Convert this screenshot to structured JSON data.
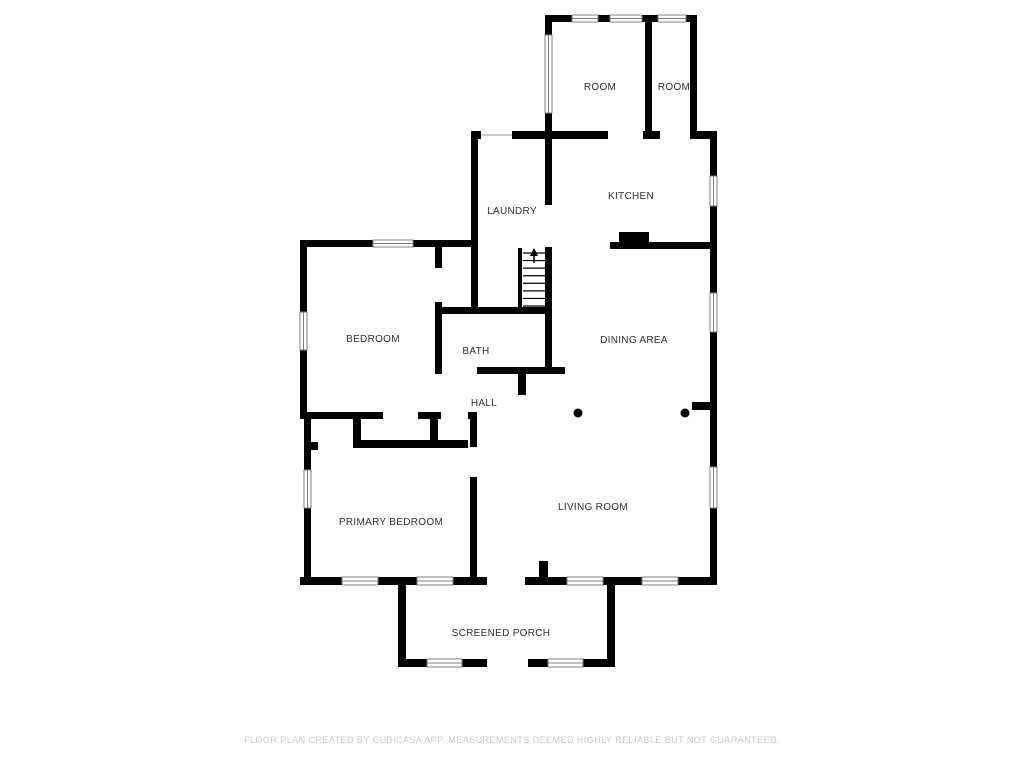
{
  "footer": {
    "text": "FLOOR PLAN CREATED BY CUBICASA APP. MEASUREMENTS DEEMED HIGHLY RELIABLE BUT NOT GUARANTEED.",
    "color": "#c9c9c9"
  },
  "plan": {
    "background": "#ffffff",
    "wall_color": "#000000",
    "label_color": "#303030",
    "window_stroke": "#7f7f7f",
    "door_line_color": "#bbbbbb",
    "rooms": [
      {
        "label": "ROOM",
        "x": 600,
        "y": 90
      },
      {
        "label": "ROOM",
        "x": 674,
        "y": 90
      },
      {
        "label": "LAUNDRY",
        "x": 512,
        "y": 214
      },
      {
        "label": "KITCHEN",
        "x": 631,
        "y": 199
      },
      {
        "label": "BEDROOM",
        "x": 373,
        "y": 342
      },
      {
        "label": "BATH",
        "x": 476,
        "y": 354
      },
      {
        "label": "DINING AREA",
        "x": 634,
        "y": 343
      },
      {
        "label": "HALL",
        "x": 484,
        "y": 406
      },
      {
        "label": "PRIMARY BEDROOM",
        "x": 391,
        "y": 525
      },
      {
        "label": "LIVING ROOM",
        "x": 593,
        "y": 510
      },
      {
        "label": "SCREENED PORCH",
        "x": 501,
        "y": 636
      }
    ],
    "walls": [
      [
        545,
        15,
        7,
        20
      ],
      [
        545,
        113,
        7,
        20
      ],
      [
        545,
        15,
        27,
        7
      ],
      [
        598,
        15,
        12,
        7
      ],
      [
        642,
        15,
        16,
        7
      ],
      [
        686,
        15,
        11,
        7
      ],
      [
        645,
        22,
        7,
        111
      ],
      [
        690,
        22,
        7,
        109
      ],
      [
        471,
        131,
        10,
        8
      ],
      [
        512,
        131,
        40,
        8
      ],
      [
        552,
        131,
        56,
        8
      ],
      [
        643,
        131,
        17,
        8
      ],
      [
        690,
        131,
        27,
        8
      ],
      [
        710,
        131,
        7,
        45
      ],
      [
        710,
        206,
        7,
        87
      ],
      [
        710,
        332,
        7,
        135
      ],
      [
        710,
        508,
        7,
        76
      ],
      [
        610,
        242,
        107,
        7
      ],
      [
        471,
        131,
        7,
        183
      ],
      [
        545,
        139,
        7,
        66
      ],
      [
        545,
        247,
        7,
        67
      ],
      [
        300,
        240,
        73,
        7
      ],
      [
        413,
        240,
        64,
        7
      ],
      [
        300,
        247,
        7,
        65
      ],
      [
        300,
        350,
        7,
        64
      ],
      [
        435,
        247,
        7,
        21
      ],
      [
        435,
        302,
        7,
        72
      ],
      [
        435,
        307,
        117,
        7
      ],
      [
        545,
        314,
        7,
        60
      ],
      [
        477,
        367,
        88,
        7
      ],
      [
        518,
        374,
        8,
        21
      ],
      [
        518,
        248,
        4,
        62
      ],
      [
        300,
        412,
        83,
        7
      ],
      [
        418,
        412,
        23,
        7
      ],
      [
        468,
        412,
        9,
        7
      ],
      [
        353,
        412,
        8,
        36
      ],
      [
        430,
        412,
        8,
        36
      ],
      [
        353,
        440,
        115,
        8
      ],
      [
        304,
        442,
        14,
        8
      ],
      [
        470,
        419,
        7,
        28
      ],
      [
        470,
        477,
        7,
        101
      ],
      [
        304,
        412,
        7,
        58
      ],
      [
        304,
        508,
        7,
        70
      ],
      [
        300,
        577,
        42,
        8
      ],
      [
        378,
        577,
        39,
        8
      ],
      [
        453,
        577,
        34,
        8
      ],
      [
        525,
        577,
        42,
        8
      ],
      [
        603,
        577,
        39,
        8
      ],
      [
        678,
        577,
        39,
        8
      ],
      [
        539,
        561,
        9,
        16
      ],
      [
        692,
        402,
        18,
        8
      ],
      [
        398,
        585,
        8,
        82
      ],
      [
        607,
        585,
        8,
        82
      ],
      [
        398,
        659,
        29,
        8
      ],
      [
        462,
        659,
        25,
        8
      ],
      [
        528,
        659,
        20,
        8
      ],
      [
        583,
        659,
        32,
        8
      ]
    ],
    "windows": [
      [
        545,
        35,
        7,
        78
      ],
      [
        572,
        15,
        26,
        7
      ],
      [
        610,
        15,
        32,
        7
      ],
      [
        658,
        15,
        28,
        7
      ],
      [
        710,
        176,
        7,
        30
      ],
      [
        710,
        293,
        7,
        39
      ],
      [
        710,
        467,
        7,
        41
      ],
      [
        373,
        240,
        40,
        7
      ],
      [
        300,
        312,
        7,
        38
      ],
      [
        304,
        470,
        7,
        38
      ],
      [
        342,
        577,
        36,
        8
      ],
      [
        417,
        577,
        36,
        8
      ],
      [
        567,
        577,
        36,
        8
      ],
      [
        642,
        577,
        36,
        8
      ],
      [
        427,
        659,
        35,
        8
      ],
      [
        548,
        659,
        35,
        8
      ]
    ],
    "door_lines": [
      [
        481,
        135,
        512,
        135
      ]
    ],
    "columns": [
      [
        578,
        413,
        4.5
      ],
      [
        685,
        413,
        4.5
      ]
    ],
    "appliances": [
      [
        619,
        232,
        30,
        16
      ]
    ],
    "stairs": {
      "x1": 523,
      "x2": 545,
      "y_top": 253,
      "y_bottom": 306,
      "treads": 8,
      "arrow_x": 534,
      "arrow_tip_y": 248
    }
  }
}
